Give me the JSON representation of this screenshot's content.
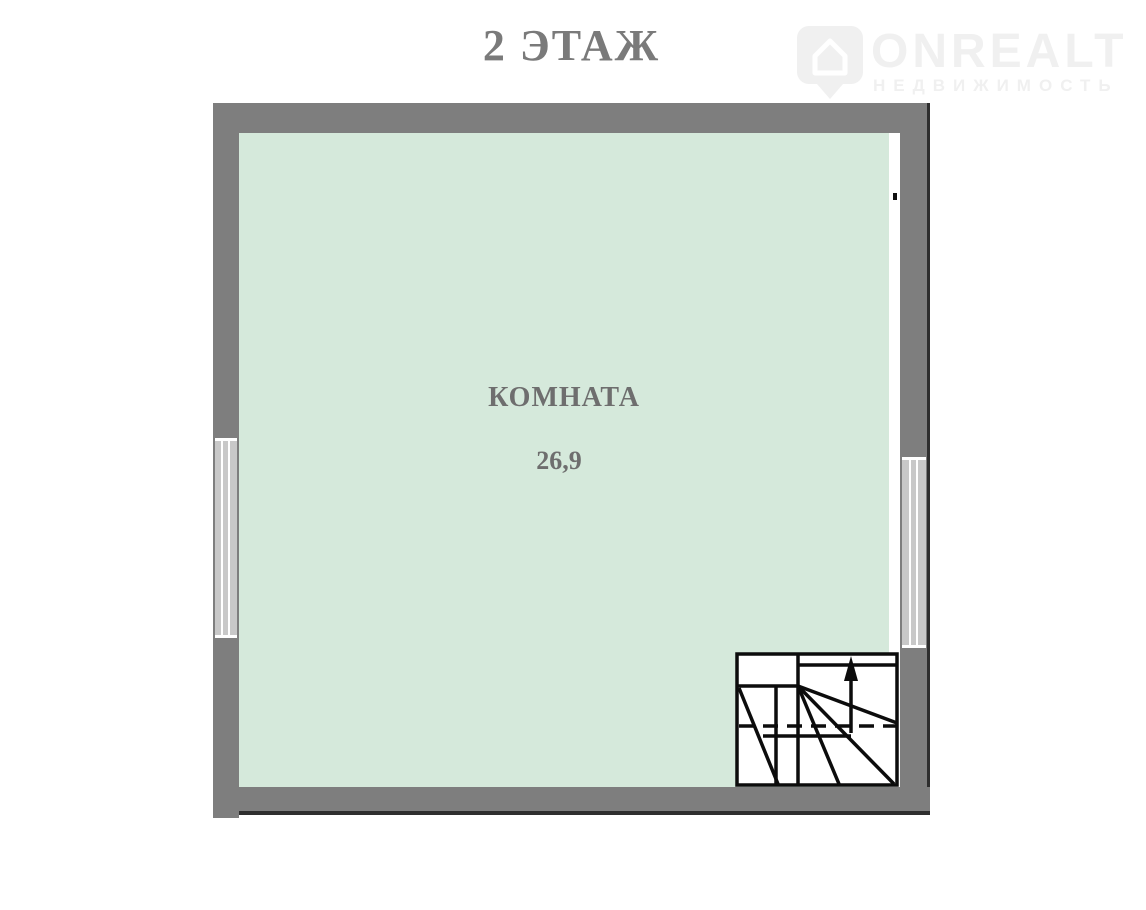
{
  "page": {
    "width": 1146,
    "height": 910,
    "background": "#ffffff"
  },
  "header": {
    "title": "2 ЭТАЖ"
  },
  "watermark": {
    "brand": "ONREALT",
    "tagline": "НЕДВИЖИМОСТЬ",
    "icon": "house-pin-icon",
    "color": "#f0f0f0"
  },
  "floorplan": {
    "room": {
      "name": "КОМНАТА",
      "area": "26,9"
    },
    "colors": {
      "wall": "#7e7e7e",
      "wall_edge": "#2e2e2e",
      "interior": "#d5e9db",
      "window": "#c8c8c8",
      "stair_line": "#0c0c0c",
      "label_text": "#6e6e6e",
      "title_text": "#7a7a7a",
      "watermark": "#f0f0f0"
    },
    "windows": [
      {
        "wall": "left"
      },
      {
        "wall": "right"
      }
    ],
    "staircase": {
      "position": "bottom-right",
      "type": "winder",
      "arrow_direction": "up"
    }
  }
}
